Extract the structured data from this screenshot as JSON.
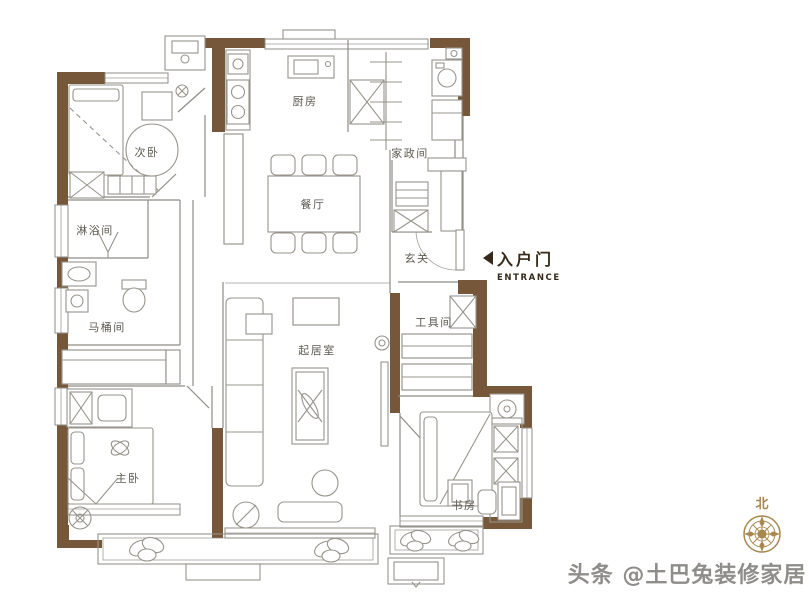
{
  "floor_plan": {
    "rooms": {
      "secondary_bedroom": "次卧",
      "kitchen": "厨房",
      "laundry_room": "家政间",
      "dining_room": "餐厅",
      "shower_room": "淋浴间",
      "foyer": "玄关",
      "toilet_room": "马桶间",
      "tool_room": "工具间",
      "living_room": "起居室",
      "master_bedroom": "主卧",
      "study": "书房"
    },
    "entrance": {
      "label": "入户门",
      "sublabel": "ENTRANCE"
    },
    "compass": {
      "north_label": "北"
    },
    "watermark": {
      "text": "头条 @土巴兔装修家居"
    },
    "colors": {
      "wall": "#76573a",
      "line": "#8f8c85",
      "furniture_line": "#98948b",
      "label_text": "#5d5a50",
      "entrance_text": "#362a1b",
      "compass_gold": "#a8874f",
      "watermark_gray": "#8f8d89",
      "background": "#ffffff"
    }
  }
}
